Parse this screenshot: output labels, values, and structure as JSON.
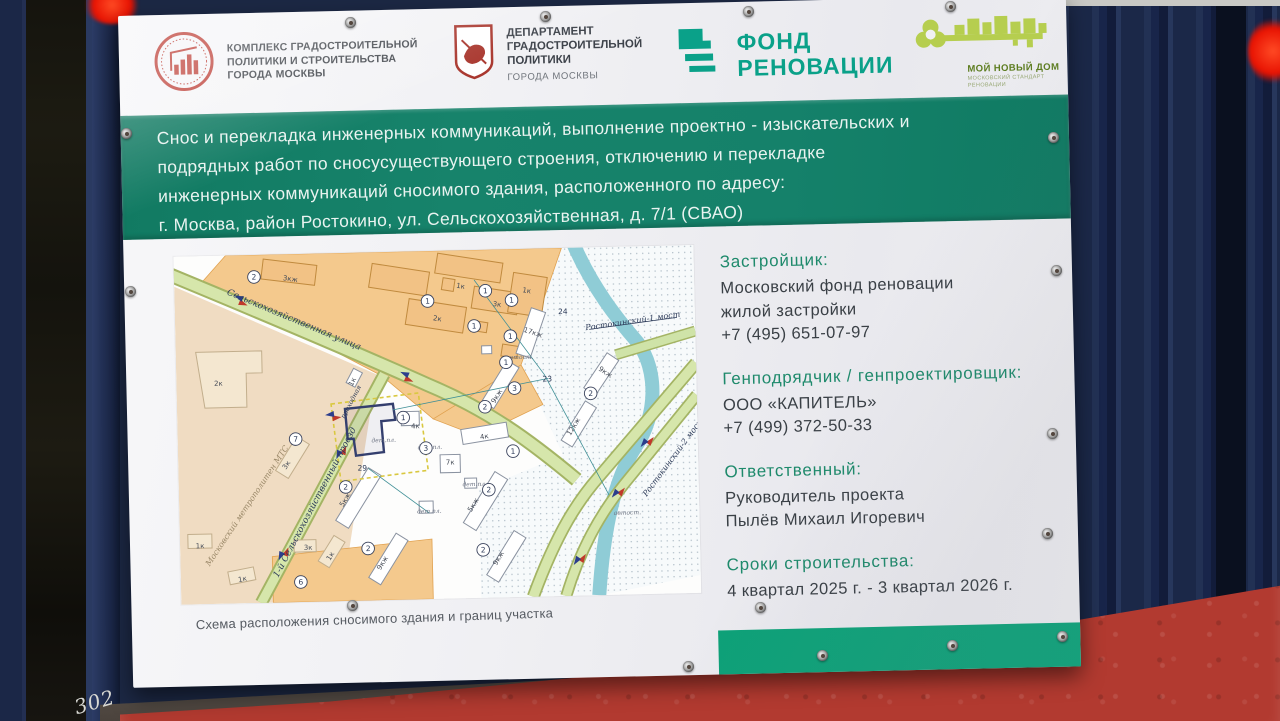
{
  "scene": {
    "graffiti": "302",
    "colors": {
      "band_green": "#15816a",
      "bottom_strip_green": "#0ca47a",
      "fund_teal": "#0aa189",
      "key_green": "#b6ce4f",
      "info_heading_teal": "#1f8a6c",
      "fence_navy": "#1b2848",
      "concrete_red": "#b23a30",
      "emblem_red": "#c0473f"
    }
  },
  "logos": {
    "complex": {
      "lines": [
        "КОМПЛЕКС ГРАДОСТРОИТЕЛЬНОЙ",
        "ПОЛИТИКИ И СТРОИТЕЛЬСТВА",
        "ГОРОДА МОСКВЫ"
      ]
    },
    "department": {
      "lines": [
        "ДЕПАРТАМЕНТ",
        "ГРАДОСТРОИТЕЛЬНОЙ",
        "ПОЛИТИКИ"
      ],
      "sub": "ГОРОДА МОСКВЫ"
    },
    "fund": {
      "lines": [
        "ФОНД",
        "РЕНОВАЦИИ"
      ]
    },
    "my_new_home": {
      "title": "МОЙ НОВЫЙ ДОМ",
      "subtitle_lines": [
        "МОСКОВСКИЙ СТАНДАРТ",
        "РЕНОВАЦИИ"
      ]
    }
  },
  "announcement": {
    "lines": [
      "Снос и перекладка инженерных коммуникаций, выполнение проектно - изыскательских и",
      "подрядных работ по сносусуществующего строения, отключению и перекладке",
      "инженерных коммуникаций сносимого здания, расположенного по адресу:",
      "г. Москва, район Ростокино, ул. Сельскохозяйственная, д. 7/1 (СВАО)"
    ]
  },
  "info": {
    "blocks": [
      {
        "heading": "Застройщик:",
        "lines": [
          "Московский фонд реновации",
          "жилой застройки",
          "+7 (495) 651-07-97"
        ]
      },
      {
        "heading": "Генподрядчик / генпроектировщик:",
        "lines": [
          "ООО «КАПИТЕЛЬ»",
          "+7 (499) 372-50-33"
        ]
      },
      {
        "heading": "Ответственный:",
        "lines": [
          "Руководитель проекта",
          "Пылёв Михаил Игоревич"
        ]
      },
      {
        "heading": "Сроки строительства:",
        "lines": [
          "4 квартал 2025 г. - 3 квартал 2026 г."
        ]
      }
    ]
  },
  "map": {
    "caption": "Схема расположения сносимого здания и границ участка",
    "labels": [
      {
        "t": "Сельскохозяйственная улица",
        "x": 118,
        "y": 68,
        "r": 24,
        "c": "street"
      },
      {
        "t": "1-й Сельскохозяйственный проезд",
        "x": 138,
        "y": 250,
        "r": -61,
        "c": "street"
      },
      {
        "t": "Московский метрополитен МТС",
        "x": 70,
        "y": 252,
        "r": -55,
        "c": "area"
      },
      {
        "t": "Ростокинский-1 мост",
        "x": 458,
        "y": 77,
        "r": -7,
        "c": "streetsm"
      },
      {
        "t": "Ростокинский-2 мост",
        "x": 497,
        "y": 213,
        "r": -52,
        "c": "streetsm"
      },
      {
        "t": "проходная",
        "x": 176,
        "y": 150,
        "r": -61,
        "c": "tiny"
      },
      {
        "t": "автост.",
        "x": 344,
        "y": 110,
        "r": 0,
        "c": "tiny2"
      },
      {
        "t": "автост.",
        "x": 448,
        "y": 268,
        "r": 0,
        "c": "tiny2"
      },
      {
        "t": "3кж",
        "x": 116,
        "y": 27,
        "r": 9,
        "c": "bldg"
      },
      {
        "t": "2к",
        "x": 262,
        "y": 70,
        "r": 10,
        "c": "bldg"
      },
      {
        "t": "3к",
        "x": 322,
        "y": 57,
        "r": 10,
        "c": "bldg"
      },
      {
        "t": "1к",
        "x": 286,
        "y": 38,
        "r": 10,
        "c": "bldg"
      },
      {
        "t": "1к",
        "x": 352,
        "y": 44,
        "r": 10,
        "c": "bldg"
      },
      {
        "t": "2к",
        "x": 42,
        "y": 130,
        "r": 0,
        "c": "bldg"
      },
      {
        "t": "17кж",
        "x": 357,
        "y": 86,
        "r": 20,
        "c": "bldg"
      },
      {
        "t": "9кж",
        "x": 428,
        "y": 127,
        "r": 35,
        "c": "bldg"
      },
      {
        "t": "24",
        "x": 388,
        "y": 66,
        "r": 0,
        "c": "num"
      },
      {
        "t": "23",
        "x": 371,
        "y": 133,
        "r": 0,
        "c": "num"
      },
      {
        "t": "29",
        "x": 184,
        "y": 218,
        "r": 0,
        "c": "num"
      },
      {
        "t": "дет.пл.",
        "x": 206,
        "y": 190,
        "r": 0,
        "c": "tiny2"
      },
      {
        "t": "4к",
        "x": 238,
        "y": 177,
        "r": 0,
        "c": "bldg"
      },
      {
        "t": "4к",
        "x": 307,
        "y": 189,
        "r": -8,
        "c": "bldg"
      },
      {
        "t": "9кж",
        "x": 322,
        "y": 148,
        "r": -57,
        "c": "bldg"
      },
      {
        "t": "5кж",
        "x": 168,
        "y": 248,
        "r": -57,
        "c": "bldg"
      },
      {
        "t": "5кж",
        "x": 296,
        "y": 256,
        "r": -57,
        "c": "bldg"
      },
      {
        "t": "9кж",
        "x": 204,
        "y": 312,
        "r": -57,
        "c": "bldg"
      },
      {
        "t": "9кж",
        "x": 320,
        "y": 310,
        "r": -57,
        "c": "bldg"
      },
      {
        "t": "12кж",
        "x": 398,
        "y": 180,
        "r": -57,
        "c": "bldg"
      },
      {
        "t": "дет.пл.",
        "x": 250,
        "y": 262,
        "r": 0,
        "c": "tiny2"
      },
      {
        "t": "дет.пл.",
        "x": 296,
        "y": 236,
        "r": 0,
        "c": "tiny2"
      },
      {
        "t": "3к",
        "x": 110,
        "y": 212,
        "r": -55,
        "c": "bldg"
      },
      {
        "t": "3к",
        "x": 128,
        "y": 296,
        "r": 0,
        "c": "bldg"
      },
      {
        "t": "1к",
        "x": 20,
        "y": 292,
        "r": 0,
        "c": "bldg"
      },
      {
        "t": "1к",
        "x": 62,
        "y": 326,
        "r": -10,
        "c": "bldg"
      },
      {
        "t": "1к",
        "x": 152,
        "y": 304,
        "r": -57,
        "c": "bldg"
      },
      {
        "t": "1к",
        "x": 178,
        "y": 130,
        "r": -61,
        "c": "bldg"
      },
      {
        "t": "7к",
        "x": 272,
        "y": 214,
        "r": 0,
        "c": "bldg"
      },
      {
        "t": "дет.пл.",
        "x": 252,
        "y": 198,
        "r": 0,
        "c": "tiny2"
      }
    ],
    "circles": [
      {
        "n": "2",
        "x": 80,
        "y": 22
      },
      {
        "n": "1",
        "x": 253,
        "y": 50
      },
      {
        "n": "1",
        "x": 311,
        "y": 41
      },
      {
        "n": "1",
        "x": 337,
        "y": 51
      },
      {
        "n": "1",
        "x": 299,
        "y": 76
      },
      {
        "n": "1",
        "x": 335,
        "y": 87
      },
      {
        "n": "1",
        "x": 330,
        "y": 113
      },
      {
        "n": "2",
        "x": 414,
        "y": 146
      },
      {
        "n": "3",
        "x": 338,
        "y": 139
      },
      {
        "n": "2",
        "x": 308,
        "y": 157
      },
      {
        "n": "3",
        "x": 248,
        "y": 197
      },
      {
        "n": "1",
        "x": 335,
        "y": 202
      },
      {
        "n": "2",
        "x": 310,
        "y": 240
      },
      {
        "n": "2",
        "x": 167,
        "y": 234
      },
      {
        "n": "2",
        "x": 303,
        "y": 300
      },
      {
        "n": "2",
        "x": 188,
        "y": 296
      },
      {
        "n": "7",
        "x": 118,
        "y": 185
      },
      {
        "n": "6",
        "x": 120,
        "y": 328
      },
      {
        "n": "1",
        "x": 226,
        "y": 166
      }
    ]
  }
}
